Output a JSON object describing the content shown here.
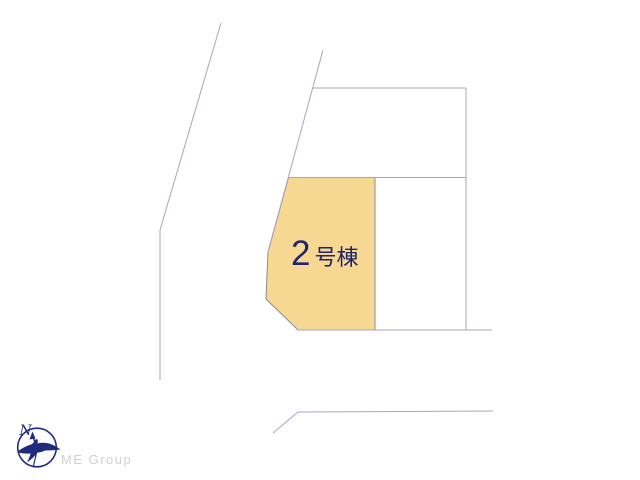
{
  "site_plan": {
    "lot_label": {
      "number": "2",
      "suffix": "号棟"
    },
    "compass": {
      "north_label": "N"
    },
    "branding": {
      "logo_text": "ME Group"
    },
    "colors": {
      "lot_fill": "#F7D892",
      "lot_border": "#8C8C94",
      "boundary_line": "#A5A5C6",
      "label_text": "#23236B",
      "compass_color": "#1F2B7D",
      "logo_text_color": "#D0D0D0"
    }
  }
}
